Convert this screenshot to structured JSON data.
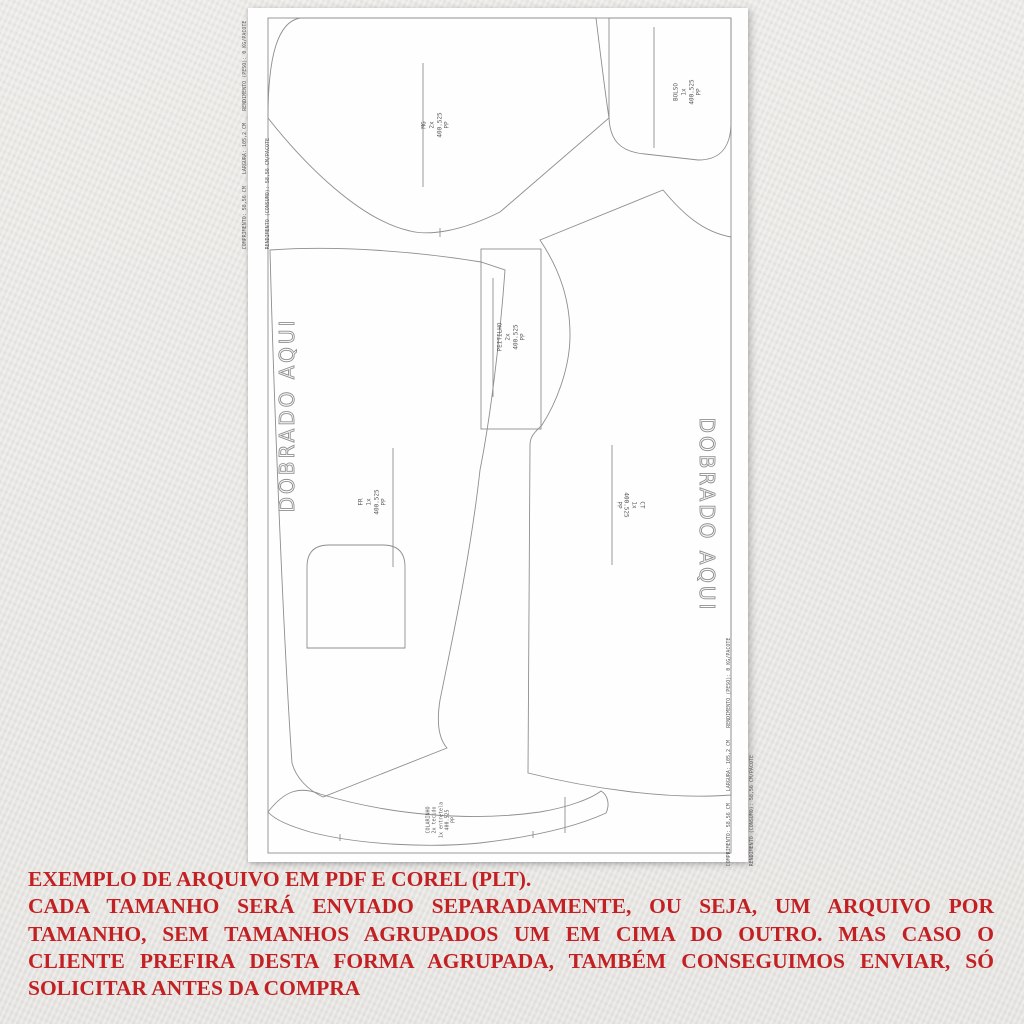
{
  "sheet": {
    "edge_info": {
      "line1": "COMPRIMENTO: 58,56 CM    LARGURA: 105,2 CM    RENDIMENTO (PESO): 0 KG/PACOTE",
      "line2": "RENDIMENTO (CONSUMO): 58,56 CM/PACOTE"
    },
    "fold_labels": {
      "left": "DOBRADO AQUI",
      "right": "DOBRADO AQUI"
    },
    "pieces": {
      "mg": {
        "name": "MG",
        "qty": "2x",
        "model": "400.525",
        "size": "PP"
      },
      "bolso": {
        "name": "BOLSO",
        "qty": "1x",
        "model": "400.525",
        "size": "PP"
      },
      "peitilho": {
        "name": "PEITILHO",
        "qty": "2x",
        "model": "400.525",
        "size": "PP"
      },
      "fr": {
        "name": "FR",
        "qty": "1x",
        "model": "400.525",
        "size": "PP"
      },
      "ct": {
        "name": "CT",
        "qty": "1x",
        "model": "400.525",
        "size": "PP"
      },
      "colarinho": {
        "name": "COLARINHO",
        "qty_fabric": "2x tecido",
        "qty_interfacing": "1x entretela",
        "model": "400.525",
        "size": "PP"
      }
    }
  },
  "caption": {
    "color": "#c32023",
    "lines": [
      "EXEMPLO DE ARQUIVO EM PDF E COREL (PLT).",
      "CADA TAMANHO SERÁ ENVIADO SEPARADAMENTE, OU SEJA, UM ARQUIVO POR",
      "TAMANHO, SEM TAMANHOS AGRUPADOS UM EM CIMA DO OUTRO. MAS CASO O",
      "CLIENTE PREFIRA DESTA FORMA AGRUPADA, TAMBÉM CONSEGUIMOS ENVIAR, SÓ",
      "SOLICITAR ANTES DA COMPRA"
    ]
  }
}
